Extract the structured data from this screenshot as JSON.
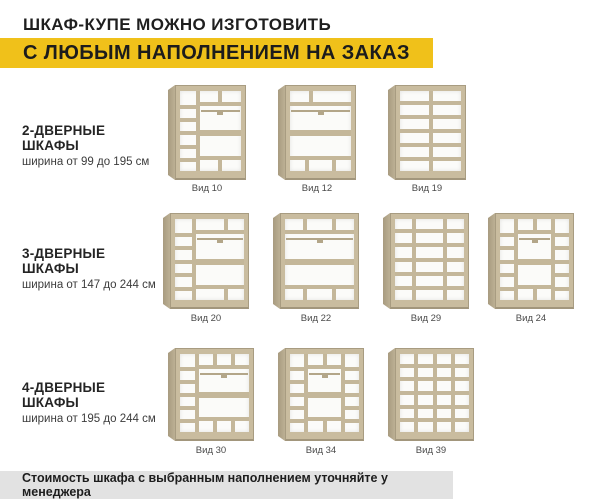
{
  "header": {
    "title": "ШКАФ-КУПЕ МОЖНО ИЗГОТОВИТЬ",
    "subtitle": "С ЛЮБЫМ НАПОЛНЕНИЕМ НА ЗАКАЗ",
    "accent_color": "#f0c11a"
  },
  "rows": [
    {
      "name": "2-ДВЕРНЫЕ ШКАФЫ",
      "width_range": "ширина от 99 до 195 см",
      "items": [
        {
          "label": "Вид 10"
        },
        {
          "label": "Вид 12"
        },
        {
          "label": "Вид 19"
        }
      ]
    },
    {
      "name": "3-ДВЕРНЫЕ ШКАФЫ",
      "width_range": "ширина от 147 до 244 см",
      "items": [
        {
          "label": "Вид 20"
        },
        {
          "label": "Вид 22"
        },
        {
          "label": "Вид 29"
        },
        {
          "label": "Вид 24"
        }
      ]
    },
    {
      "name": "4-ДВЕРНЫЕ ШКАФЫ",
      "width_range": "ширина от 195 до 244 см",
      "items": [
        {
          "label": "Вид 30"
        },
        {
          "label": "Вид 34"
        },
        {
          "label": "Вид 39"
        }
      ]
    }
  ],
  "footer": {
    "note": "Стоимость шкафа с выбранным наполнением уточняйте у менеджера",
    "bg_color": "#e2e2e2"
  },
  "colors": {
    "wood": "#c9bc9f",
    "wood_dark": "#a89c81",
    "interior": "#fbfbf9"
  }
}
